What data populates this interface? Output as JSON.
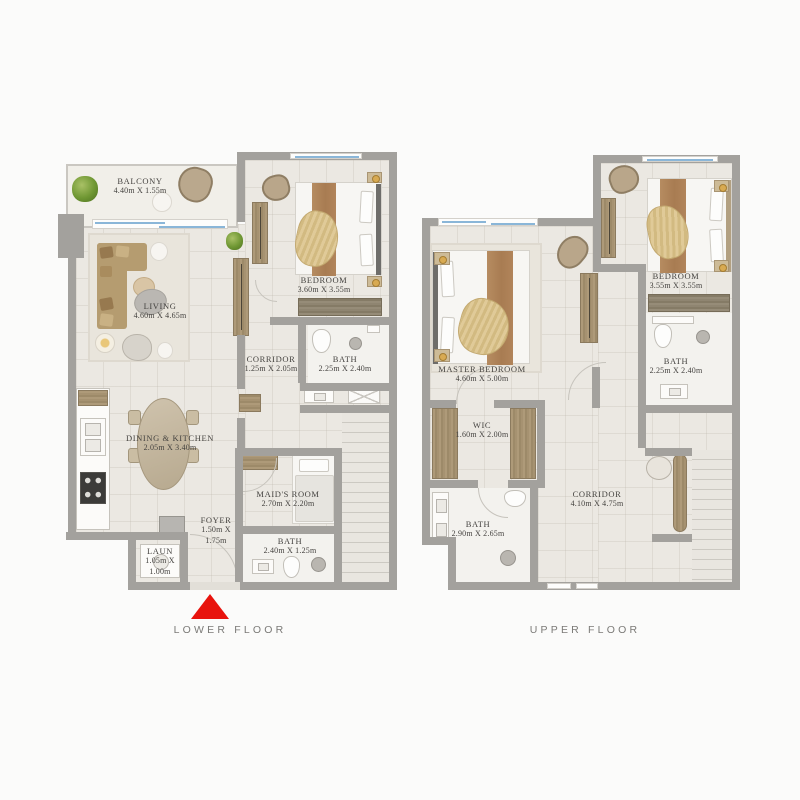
{
  "captions": {
    "lower": "LOWER FLOOR",
    "upper": "UPPER FLOOR"
  },
  "colors": {
    "accent_red": "#e8130d",
    "wall_gray": "#a3a19d",
    "floor_beige": "#ebe8e2",
    "wood": "#a69271",
    "window_blue": "#8ab6d8"
  },
  "lower": {
    "rooms": {
      "balcony": {
        "name": "BALCONY",
        "dims": "4.40m X 1.55m"
      },
      "living": {
        "name": "LIVING",
        "dims": "4.60m X 4.65m"
      },
      "bedroom": {
        "name": "BEDROOM",
        "dims": "3.60m X 3.55m"
      },
      "corridor": {
        "name": "CORRIDOR",
        "dims": "1.25m X 2.05m"
      },
      "bath1": {
        "name": "BATH",
        "dims": "2.25m X 2.40m"
      },
      "dining": {
        "name": "DINING & KITCHEN",
        "dims": "2.05m X 3.40m"
      },
      "maids": {
        "name": "MAID'S ROOM",
        "dims": "2.70m X 2.20m"
      },
      "foyer": {
        "name": "FOYER",
        "dims": "1.50m X 1.75m"
      },
      "laun": {
        "name": "LAUN",
        "dims": "1.05m X 1.00m"
      },
      "bath2": {
        "name": "BATH",
        "dims": "2.40m X 1.25m"
      }
    }
  },
  "upper": {
    "rooms": {
      "master": {
        "name": "MASTER BEDROOM",
        "dims": "4.60m X 5.00m"
      },
      "bedroom": {
        "name": "BEDROOM",
        "dims": "3.55m X 3.55m"
      },
      "wic": {
        "name": "WIC",
        "dims": "1.60m X 2.00m"
      },
      "bath1": {
        "name": "BATH",
        "dims": "2.25m X 2.40m"
      },
      "bath2": {
        "name": "BATH",
        "dims": "2.90m X 2.65m"
      },
      "corridor": {
        "name": "CORRIDOR",
        "dims": "4.10m X 4.75m"
      }
    }
  }
}
